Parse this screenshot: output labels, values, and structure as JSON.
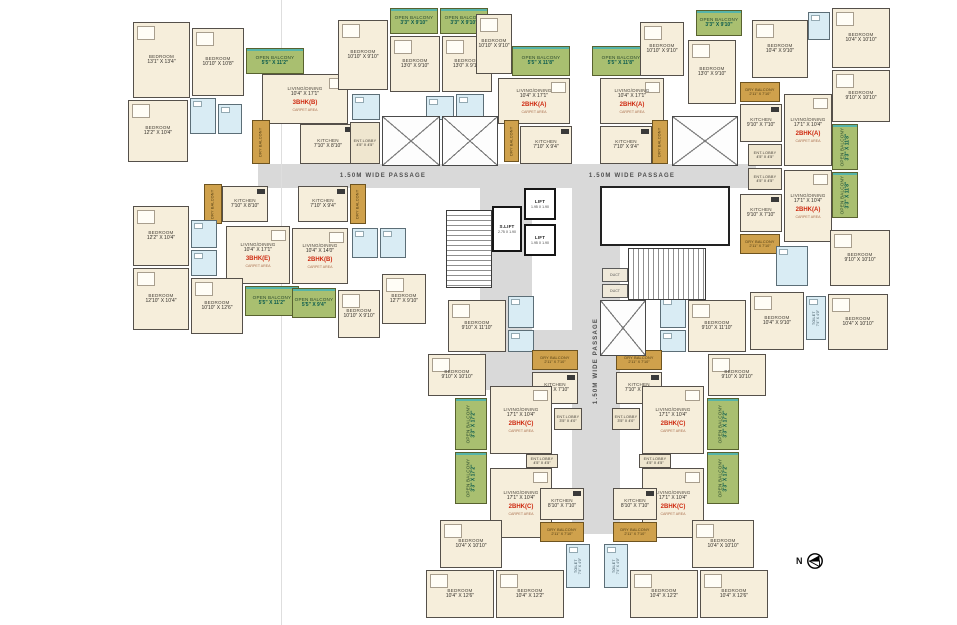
{
  "north": {
    "label": "N"
  },
  "fold": {
    "x": 281,
    "y": 0,
    "w": 1,
    "h": 625
  },
  "passages": [
    {
      "label": "1.50M WIDE PASSAGE",
      "o": "h",
      "x": 258,
      "y": 164,
      "w": 250,
      "h": 24
    },
    {
      "label": "1.50M WIDE PASSAGE",
      "o": "h",
      "x": 508,
      "y": 164,
      "w": 248,
      "h": 24
    },
    {
      "label": "",
      "o": "v",
      "x": 480,
      "y": 188,
      "w": 52,
      "h": 160
    },
    {
      "label": "1.50M WIDE PASSAGE",
      "o": "v",
      "x": 572,
      "y": 188,
      "w": 48,
      "h": 346
    },
    {
      "label": "",
      "o": "v",
      "x": 480,
      "y": 330,
      "w": 96,
      "h": 60
    }
  ],
  "core": {
    "stairs": [
      {
        "x": 446,
        "y": 210,
        "w": 46,
        "h": 78,
        "dir": "v"
      },
      {
        "x": 628,
        "y": 248,
        "w": 78,
        "h": 52,
        "dir": "h"
      }
    ],
    "lifts": [
      {
        "label": "LIFT",
        "dims": "1.95 X 1.90",
        "x": 524,
        "y": 188,
        "w": 32,
        "h": 32
      },
      {
        "label": "LIFT",
        "dims": "1.95 X 1.90",
        "x": 524,
        "y": 224,
        "w": 32,
        "h": 32
      },
      {
        "label": "S.LIFT",
        "dims": "2.75 X 1.90",
        "x": 492,
        "y": 206,
        "w": 30,
        "h": 46
      }
    ],
    "voids": [
      {
        "x": 382,
        "y": 116,
        "w": 58,
        "h": 50
      },
      {
        "x": 442,
        "y": 116,
        "w": 56,
        "h": 50
      },
      {
        "x": 672,
        "y": 116,
        "w": 66,
        "h": 50
      },
      {
        "x": 600,
        "y": 300,
        "w": 46,
        "h": 56
      }
    ],
    "refuge": {
      "x": 600,
      "y": 186,
      "w": 130,
      "h": 60
    },
    "ducts": [
      {
        "label": "DUCT",
        "x": 602,
        "y": 268,
        "w": 26,
        "h": 14
      },
      {
        "label": "DUCT",
        "x": 602,
        "y": 284,
        "w": 26,
        "h": 14
      }
    ]
  },
  "rooms": [
    {
      "t": "bed",
      "l": "BEDROOM",
      "d": "13'1\" X 13'4\"",
      "x": 133,
      "y": 22,
      "w": 57,
      "h": 76
    },
    {
      "t": "bed",
      "l": "BEDROOM",
      "d": "10'10\" X 10'8\"",
      "x": 192,
      "y": 28,
      "w": 52,
      "h": 68
    },
    {
      "t": "ob",
      "l": "OPEN BALCONY",
      "d": "5'5\" X 11'2\"",
      "x": 246,
      "y": 48,
      "w": 58,
      "h": 26
    },
    {
      "t": "bed",
      "l": "BEDROOM",
      "d": "12'2\" X 10'4\"",
      "x": 128,
      "y": 100,
      "w": 60,
      "h": 62
    },
    {
      "t": "wc",
      "x": 190,
      "y": 98,
      "w": 26,
      "h": 36
    },
    {
      "t": "wc",
      "x": 218,
      "y": 104,
      "w": 24,
      "h": 30
    },
    {
      "t": "liv",
      "l": "LIVING/DINING",
      "d": "10'4\" X 17'1\"",
      "u": "3BHK(B)",
      "n": "CARPET AREA",
      "x": 262,
      "y": 74,
      "w": 86,
      "h": 50
    },
    {
      "t": "kit",
      "l": "KITCHEN",
      "d": "7'10\" X 8'10\"",
      "x": 300,
      "y": 124,
      "w": 56,
      "h": 40
    },
    {
      "t": "db",
      "l": "DRY BALCONY",
      "o": "v",
      "x": 252,
      "y": 120,
      "w": 18,
      "h": 44
    },
    {
      "t": "lob",
      "l": "ENT.LOBBY",
      "d": "4'5\" X 4'5\"",
      "x": 350,
      "y": 122,
      "w": 30,
      "h": 42
    },
    {
      "t": "bed",
      "l": "BEDROOM",
      "d": "10'10\" X 9'10\"",
      "x": 338,
      "y": 20,
      "w": 50,
      "h": 70
    },
    {
      "t": "ob",
      "l": "OPEN BALCONY",
      "d": "3'3\" X 9'10\"",
      "x": 390,
      "y": 8,
      "w": 48,
      "h": 26
    },
    {
      "t": "bed",
      "l": "BEDROOM",
      "d": "13'0\" X 9'10\"",
      "x": 390,
      "y": 36,
      "w": 50,
      "h": 56
    },
    {
      "t": "ob",
      "l": "OPEN BALCONY",
      "d": "3'3\" X 9'10\"",
      "x": 440,
      "y": 8,
      "w": 48,
      "h": 26
    },
    {
      "t": "bed",
      "l": "BEDROOM",
      "d": "13'0\" X 9'10\"",
      "x": 442,
      "y": 36,
      "w": 50,
      "h": 56
    },
    {
      "t": "bed",
      "l": "BEDROOM",
      "d": "10'10\" X 9'10\"",
      "x": 476,
      "y": 14,
      "w": 36,
      "h": 60
    },
    {
      "t": "wc",
      "x": 352,
      "y": 94,
      "w": 28,
      "h": 26
    },
    {
      "t": "wc",
      "x": 426,
      "y": 96,
      "w": 28,
      "h": 24
    },
    {
      "t": "wc",
      "x": 456,
      "y": 94,
      "w": 28,
      "h": 26
    },
    {
      "t": "ob",
      "l": "OPEN BALCONY",
      "d": "5'5\" X 11'8\"",
      "x": 512,
      "y": 46,
      "w": 58,
      "h": 30
    },
    {
      "t": "liv",
      "l": "LIVING/DINING",
      "d": "10'4\" X 17'1\"",
      "u": "2BHK(A)",
      "n": "CARPET AREA",
      "x": 498,
      "y": 78,
      "w": 72,
      "h": 46
    },
    {
      "t": "kit",
      "l": "KITCHEN",
      "d": "7'10\" X 9'4\"",
      "x": 520,
      "y": 126,
      "w": 52,
      "h": 38
    },
    {
      "t": "db",
      "l": "DRY BALCONY",
      "o": "v",
      "x": 504,
      "y": 120,
      "w": 15,
      "h": 42
    },
    {
      "t": "ob",
      "l": "OPEN BALCONY",
      "d": "5'5\" X 11'8\"",
      "x": 592,
      "y": 46,
      "w": 58,
      "h": 30
    },
    {
      "t": "liv",
      "l": "LIVING/DINING",
      "d": "10'4\" X 17'1\"",
      "u": "2BHK(A)",
      "n": "CARPET AREA",
      "x": 600,
      "y": 78,
      "w": 64,
      "h": 46
    },
    {
      "t": "kit",
      "l": "KITCHEN",
      "d": "7'10\" X 9'4\"",
      "x": 600,
      "y": 126,
      "w": 52,
      "h": 38
    },
    {
      "t": "db",
      "l": "DRY BALCONY",
      "o": "v",
      "x": 652,
      "y": 120,
      "w": 16,
      "h": 44
    },
    {
      "t": "bed",
      "l": "BEDROOM",
      "d": "10'10\" X 9'10\"",
      "x": 640,
      "y": 22,
      "w": 44,
      "h": 54
    },
    {
      "t": "ob",
      "l": "OPEN BALCONY",
      "d": "3'3\" X 9'10\"",
      "x": 696,
      "y": 10,
      "w": 46,
      "h": 26
    },
    {
      "t": "bed",
      "l": "BEDROOM",
      "d": "13'0\" X 9'10\"",
      "x": 688,
      "y": 40,
      "w": 48,
      "h": 64
    },
    {
      "t": "bed",
      "l": "BEDROOM",
      "d": "10'4\" X 9'10\"",
      "x": 752,
      "y": 20,
      "w": 56,
      "h": 58
    },
    {
      "t": "wc",
      "x": 808,
      "y": 12,
      "w": 22,
      "h": 28
    },
    {
      "t": "bed",
      "l": "BEDROOM",
      "d": "10'4\" X 10'10\"",
      "x": 832,
      "y": 8,
      "w": 58,
      "h": 60
    },
    {
      "t": "bed",
      "l": "BEDROOM",
      "d": "9'10\" X 10'10\"",
      "x": 832,
      "y": 70,
      "w": 58,
      "h": 52
    },
    {
      "t": "db",
      "l": "DRY BALCONY",
      "d": "2'11\" X 7'10\"",
      "x": 740,
      "y": 82,
      "w": 40,
      "h": 20
    },
    {
      "t": "kit",
      "l": "KITCHEN",
      "d": "9'10\" X 7'10\"",
      "x": 740,
      "y": 104,
      "w": 42,
      "h": 38
    },
    {
      "t": "liv",
      "l": "LIVING/DINING",
      "d": "17'1\" X 10'4\"",
      "u": "2BHK(A)",
      "n": "CARPET AREA",
      "x": 784,
      "y": 94,
      "w": 48,
      "h": 72
    },
    {
      "t": "ob",
      "l": "OPEN BALCONY",
      "d": "3'3\" X 11'8\"",
      "o": "v",
      "x": 832,
      "y": 124,
      "w": 26,
      "h": 46
    },
    {
      "t": "lob",
      "l": "ENT.LOBBY",
      "d": "4'5\" X 4'5\"",
      "x": 748,
      "y": 144,
      "w": 34,
      "h": 22
    },
    {
      "t": "lob",
      "l": "ENT.LOBBY",
      "d": "4'5\" X 4'5\"",
      "x": 748,
      "y": 168,
      "w": 34,
      "h": 22
    },
    {
      "t": "liv",
      "l": "LIVING/DINING",
      "d": "17'1\" X 10'4\"",
      "u": "2BHK(A)",
      "n": "CARPET AREA",
      "x": 784,
      "y": 170,
      "w": 48,
      "h": 72
    },
    {
      "t": "kit",
      "l": "KITCHEN",
      "d": "9'10\" X 7'10\"",
      "x": 740,
      "y": 194,
      "w": 42,
      "h": 38
    },
    {
      "t": "db",
      "l": "DRY BALCONY",
      "d": "2'11\" X 7'10\"",
      "x": 740,
      "y": 234,
      "w": 40,
      "h": 20
    },
    {
      "t": "ob",
      "l": "OPEN BALCONY",
      "d": "3'3\" X 11'8\"",
      "o": "v",
      "x": 832,
      "y": 172,
      "w": 26,
      "h": 46
    },
    {
      "t": "bed",
      "l": "BEDROOM",
      "d": "9'10\" X 10'10\"",
      "x": 830,
      "y": 230,
      "w": 60,
      "h": 56
    },
    {
      "t": "wc",
      "x": 776,
      "y": 246,
      "w": 32,
      "h": 40
    },
    {
      "t": "bed",
      "l": "BEDROOM",
      "d": "10'4\" X 9'10\"",
      "x": 750,
      "y": 292,
      "w": 54,
      "h": 58
    },
    {
      "t": "wc",
      "l": "TOILET",
      "d": "7'4\" X 4'0\"",
      "o": "v",
      "x": 806,
      "y": 296,
      "w": 20,
      "h": 44
    },
    {
      "t": "bed",
      "l": "BEDROOM",
      "d": "10'4\" X 10'10\"",
      "x": 828,
      "y": 294,
      "w": 60,
      "h": 56
    },
    {
      "t": "db",
      "l": "DRY BALCONY",
      "o": "v",
      "x": 204,
      "y": 184,
      "w": 18,
      "h": 40
    },
    {
      "t": "kit",
      "l": "KITCHEN",
      "d": "7'10\" X 8'10\"",
      "x": 222,
      "y": 186,
      "w": 46,
      "h": 36
    },
    {
      "t": "bed",
      "l": "BEDROOM",
      "d": "12'2\" X 10'4\"",
      "x": 133,
      "y": 206,
      "w": 56,
      "h": 60
    },
    {
      "t": "wc",
      "x": 191,
      "y": 220,
      "w": 26,
      "h": 28
    },
    {
      "t": "wc",
      "x": 191,
      "y": 250,
      "w": 26,
      "h": 26
    },
    {
      "t": "liv",
      "l": "LIVING/DINING",
      "d": "10'4\" X 17'1\"",
      "u": "3BHK(E)",
      "n": "CARPET AREA",
      "x": 226,
      "y": 226,
      "w": 64,
      "h": 58
    },
    {
      "t": "bed",
      "l": "BEDROOM",
      "d": "12'10\" X 10'4\"",
      "x": 133,
      "y": 268,
      "w": 56,
      "h": 62
    },
    {
      "t": "bed",
      "l": "BEDROOM",
      "d": "10'10\" X 12'6\"",
      "x": 191,
      "y": 278,
      "w": 52,
      "h": 56
    },
    {
      "t": "ob",
      "l": "OPEN BALCONY",
      "d": "5'5\" X 11'2\"",
      "x": 245,
      "y": 286,
      "w": 54,
      "h": 30
    },
    {
      "t": "kit",
      "l": "KITCHEN",
      "d": "7'10\" X 9'4\"",
      "x": 298,
      "y": 186,
      "w": 50,
      "h": 36
    },
    {
      "t": "db",
      "l": "DRY BALCONY",
      "o": "v",
      "x": 350,
      "y": 184,
      "w": 16,
      "h": 40
    },
    {
      "t": "liv",
      "l": "LIVING/DINING",
      "d": "10'4\" X 14'0\"",
      "u": "2BHK(B)",
      "n": "CARPET AREA",
      "x": 292,
      "y": 228,
      "w": 56,
      "h": 56
    },
    {
      "t": "wc",
      "x": 352,
      "y": 228,
      "w": 26,
      "h": 30
    },
    {
      "t": "wc",
      "x": 380,
      "y": 228,
      "w": 26,
      "h": 30
    },
    {
      "t": "ob",
      "l": "OPEN BALCONY",
      "d": "5'5\" X 9'4\"",
      "x": 292,
      "y": 288,
      "w": 44,
      "h": 30
    },
    {
      "t": "bed",
      "l": "BEDROOM",
      "d": "10'10\" X 9'10\"",
      "x": 338,
      "y": 290,
      "w": 42,
      "h": 48
    },
    {
      "t": "bed",
      "l": "BEDROOM",
      "d": "12'7\" X 9'10\"",
      "x": 382,
      "y": 274,
      "w": 44,
      "h": 50
    },
    {
      "t": "bed",
      "l": "BEDROOM",
      "d": "9'10\" X 11'10\"",
      "x": 448,
      "y": 300,
      "w": 58,
      "h": 52
    },
    {
      "t": "bed",
      "l": "BEDROOM",
      "d": "9'10\" X 10'10\"",
      "x": 428,
      "y": 354,
      "w": 58,
      "h": 42
    },
    {
      "t": "ob",
      "l": "OPEN BALCONY",
      "d": "3'3\" X 17'2\"",
      "o": "v",
      "x": 455,
      "y": 398,
      "w": 32,
      "h": 52
    },
    {
      "t": "ob",
      "l": "OPEN BALCONY",
      "d": "3'3\" X 17'2\"",
      "o": "v",
      "x": 455,
      "y": 452,
      "w": 32,
      "h": 52
    },
    {
      "t": "wc",
      "x": 508,
      "y": 296,
      "w": 26,
      "h": 32
    },
    {
      "t": "wc",
      "x": 508,
      "y": 330,
      "w": 26,
      "h": 22
    },
    {
      "t": "db",
      "l": "DRY BALCONY",
      "d": "2'11\" X 7'10\"",
      "x": 532,
      "y": 350,
      "w": 46,
      "h": 20
    },
    {
      "t": "kit",
      "l": "KITCHEN",
      "d": "7'10\" X 7'10\"",
      "x": 532,
      "y": 372,
      "w": 46,
      "h": 32
    },
    {
      "t": "liv",
      "l": "LIVING/DINING",
      "d": "17'1\" X 10'4\"",
      "u": "2BHK(C)",
      "n": "CARPET AREA",
      "x": 490,
      "y": 386,
      "w": 62,
      "h": 68
    },
    {
      "t": "lob",
      "l": "ENT.LOBBY",
      "d": "3'5\" X 4'0\"",
      "x": 554,
      "y": 408,
      "w": 28,
      "h": 22
    },
    {
      "t": "lob",
      "l": "ENT.LOBBY",
      "d": "4'5\" X 4'5\"",
      "x": 526,
      "y": 454,
      "w": 32,
      "h": 14
    },
    {
      "t": "liv",
      "l": "LIVING/DINING",
      "d": "17'1\" X 10'4\"",
      "u": "2BHK(C)",
      "n": "CARPET AREA",
      "x": 490,
      "y": 468,
      "w": 62,
      "h": 70
    },
    {
      "t": "kit",
      "l": "KITCHEN",
      "d": "8'10\" X 7'10\"",
      "x": 540,
      "y": 488,
      "w": 44,
      "h": 32
    },
    {
      "t": "db",
      "l": "DRY BALCONY",
      "d": "2'11\" X 7'10\"",
      "x": 540,
      "y": 522,
      "w": 44,
      "h": 20
    },
    {
      "t": "bed",
      "l": "BEDROOM",
      "d": "10'4\" X 10'10\"",
      "x": 440,
      "y": 520,
      "w": 62,
      "h": 48
    },
    {
      "t": "bed",
      "l": "BEDROOM",
      "d": "10'4\" X 12'6\"",
      "x": 426,
      "y": 570,
      "w": 68,
      "h": 48
    },
    {
      "t": "bed",
      "l": "BEDROOM",
      "d": "10'4\" X 12'2\"",
      "x": 496,
      "y": 570,
      "w": 68,
      "h": 48
    },
    {
      "t": "wc",
      "l": "TOILET",
      "d": "7'4\" X 4'0\"",
      "o": "v",
      "x": 566,
      "y": 544,
      "w": 24,
      "h": 44
    },
    {
      "t": "bed",
      "l": "BEDROOM",
      "d": "9'10\" X 11'10\"",
      "x": 688,
      "y": 300,
      "w": 58,
      "h": 52
    },
    {
      "t": "bed",
      "l": "BEDROOM",
      "d": "9'10\" X 10'10\"",
      "x": 708,
      "y": 354,
      "w": 58,
      "h": 42
    },
    {
      "t": "ob",
      "l": "OPEN BALCONY",
      "d": "3'3\" X 17'2\"",
      "o": "v",
      "x": 707,
      "y": 398,
      "w": 32,
      "h": 52
    },
    {
      "t": "ob",
      "l": "OPEN BALCONY",
      "d": "3'3\" X 17'2\"",
      "o": "v",
      "x": 707,
      "y": 452,
      "w": 32,
      "h": 52
    },
    {
      "t": "wc",
      "x": 660,
      "y": 296,
      "w": 26,
      "h": 32
    },
    {
      "t": "wc",
      "x": 660,
      "y": 330,
      "w": 26,
      "h": 22
    },
    {
      "t": "db",
      "l": "DRY BALCONY",
      "d": "2'11\" X 7'10\"",
      "x": 616,
      "y": 350,
      "w": 46,
      "h": 20
    },
    {
      "t": "kit",
      "l": "KITCHEN",
      "d": "7'10\" X 7'10\"",
      "x": 616,
      "y": 372,
      "w": 46,
      "h": 32
    },
    {
      "t": "liv",
      "l": "LIVING/DINING",
      "d": "17'1\" X 10'4\"",
      "u": "2BHK(C)",
      "n": "CARPET AREA",
      "x": 642,
      "y": 386,
      "w": 62,
      "h": 68
    },
    {
      "t": "lob",
      "l": "ENT.LOBBY",
      "d": "3'5\" X 4'0\"",
      "x": 612,
      "y": 408,
      "w": 28,
      "h": 22
    },
    {
      "t": "lob",
      "l": "ENT.LOBBY",
      "d": "4'5\" X 4'5\"",
      "x": 639,
      "y": 454,
      "w": 32,
      "h": 14
    },
    {
      "t": "liv",
      "l": "LIVING/DINING",
      "d": "17'1\" X 10'4\"",
      "u": "2BHK(C)",
      "n": "CARPET AREA",
      "x": 642,
      "y": 468,
      "w": 62,
      "h": 70
    },
    {
      "t": "kit",
      "l": "KITCHEN",
      "d": "8'10\" X 7'10\"",
      "x": 613,
      "y": 488,
      "w": 44,
      "h": 32
    },
    {
      "t": "db",
      "l": "DRY BALCONY",
      "d": "2'11\" X 7'10\"",
      "x": 613,
      "y": 522,
      "w": 44,
      "h": 20
    },
    {
      "t": "bed",
      "l": "BEDROOM",
      "d": "10'4\" X 10'10\"",
      "x": 692,
      "y": 520,
      "w": 62,
      "h": 48
    },
    {
      "t": "bed",
      "l": "BEDROOM",
      "d": "10'4\" X 12'2\"",
      "x": 630,
      "y": 570,
      "w": 68,
      "h": 48
    },
    {
      "t": "bed",
      "l": "BEDROOM",
      "d": "10'4\" X 12'6\"",
      "x": 700,
      "y": 570,
      "w": 68,
      "h": 48
    },
    {
      "t": "wc",
      "l": "TOILET",
      "d": "7'4\" X 4'0\"",
      "o": "v",
      "x": 604,
      "y": 544,
      "w": 24,
      "h": 44
    }
  ]
}
